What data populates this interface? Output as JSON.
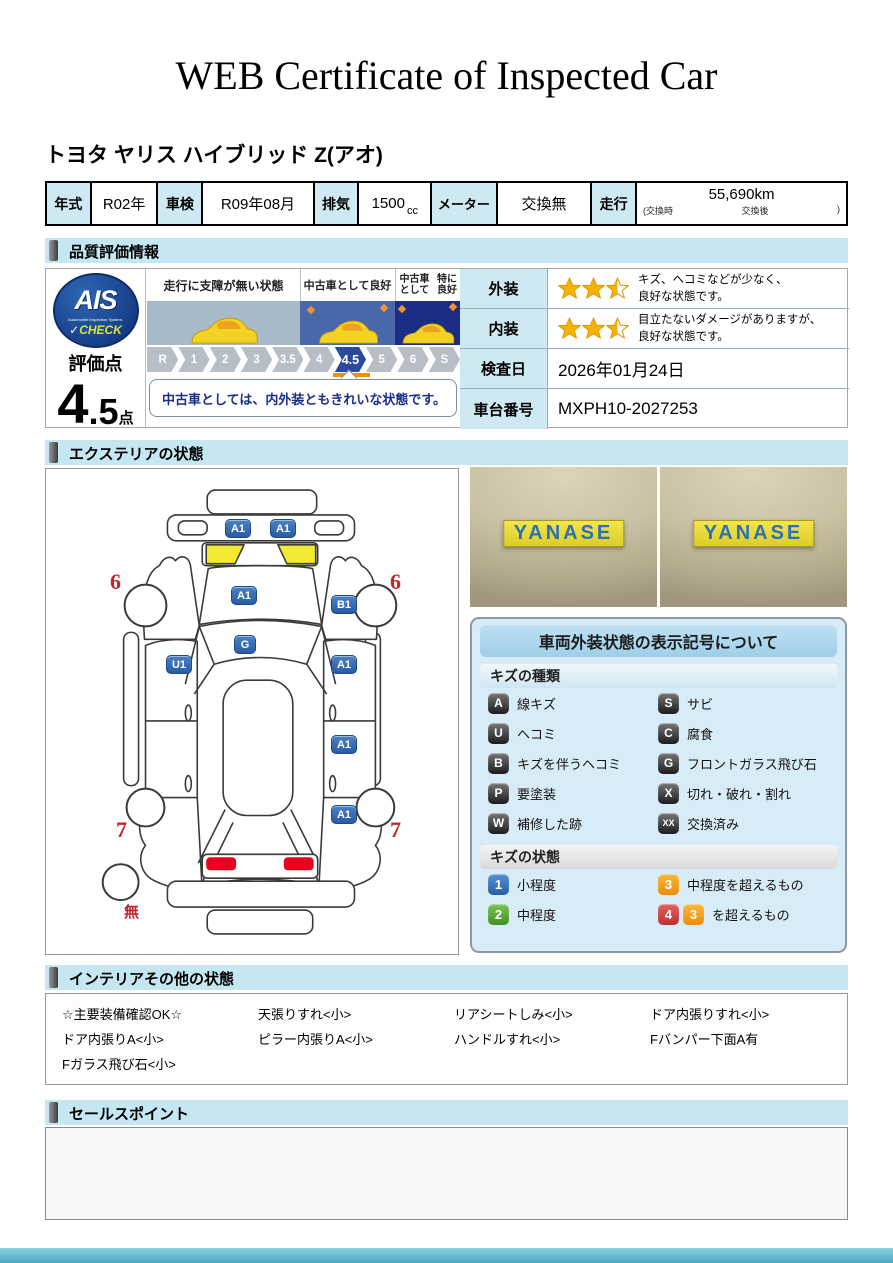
{
  "page": {
    "title": "WEB Certificate of Inspected Car",
    "vehicle_name": "トヨタ ヤリス ハイブリッド Z(アオ)"
  },
  "spec": {
    "year_label": "年式",
    "year_value": "R02年",
    "inspection_label": "車検",
    "inspection_value": "R09年08月",
    "displacement_label": "排気",
    "displacement_value": "1500",
    "displacement_unit": "cc",
    "meter_label": "メーター",
    "meter_value": "交換無",
    "mileage_label": "走行",
    "mileage_value": "55,690km",
    "mileage_sub_left": "(交換時",
    "mileage_sub_mid": "交換後",
    "mileage_sub_right": ")"
  },
  "sections": {
    "quality": "品質評価情報",
    "exterior": "エクステリアの状態",
    "interior": "インテリアその他の状態",
    "sales": "セールスポイント"
  },
  "quality": {
    "ais": {
      "logo": "AIS",
      "logo_sub": "Automobile Inspection System.",
      "check_mark": "✓",
      "logo_check": "CHECK"
    },
    "score_label": "評価点",
    "score_int": "4",
    "score_dec": ".5",
    "score_unit": "点",
    "zone_labels": [
      "走行に支障が無い状態",
      "中古車として良好",
      "中古車として",
      "特に良好"
    ],
    "scale": [
      "R",
      "1",
      "2",
      "3",
      "3.5",
      "4",
      "4.5",
      "5",
      "6",
      "S"
    ],
    "active_grade": "4.5",
    "comment": "中古車としては、内外装ともきれいな状態です。",
    "exterior_label": "外装",
    "exterior_text1": "キズ、ヘコミなどが少なく、",
    "exterior_text2": "良好な状態です。",
    "interior_label": "内装",
    "interior_text1": "目立たないダメージがありますが、",
    "interior_text2": "良好な状態です。",
    "date_label": "検査日",
    "date_value": "2026年01月24日",
    "vin_label": "車台番号",
    "vin_value": "MXPH10-2027253"
  },
  "diagram": {
    "markers": {
      "bumper_l": "A1",
      "bumper_r": "A1",
      "hood": "A1",
      "fender_r": "B1",
      "windshield": "G",
      "door_fl": "U1",
      "door_fr": "A1",
      "door_rr": "A1",
      "quarter_r": "A1",
      "wheel_fl": "6",
      "wheel_fr": "6",
      "wheel_rl": "7",
      "wheel_rr": "7",
      "spare": "無"
    }
  },
  "photos": {
    "sign1": "YANASE",
    "sign2": "YANASE"
  },
  "legend": {
    "title": "車両外装状態の表示記号について",
    "kinds_header": "キズの種類",
    "kinds": [
      {
        "code": "A",
        "label": "線キズ"
      },
      {
        "code": "S",
        "label": "サビ"
      },
      {
        "code": "U",
        "label": "ヘコミ"
      },
      {
        "code": "C",
        "label": "腐食"
      },
      {
        "code": "B",
        "label": "キズを伴うヘコミ"
      },
      {
        "code": "G",
        "label": "フロントガラス飛び石"
      },
      {
        "code": "P",
        "label": "要塗装"
      },
      {
        "code": "X",
        "label": "切れ・破れ・割れ"
      },
      {
        "code": "W",
        "label": "補修した跡"
      },
      {
        "code": "XX",
        "label": "交換済み"
      }
    ],
    "states_header": "キズの状態",
    "states": [
      {
        "code": "1",
        "label": "小程度"
      },
      {
        "code": "3",
        "label": "中程度を超えるもの"
      },
      {
        "code": "2",
        "label": "中程度"
      },
      {
        "code": "4",
        "code2": "3",
        "label": "を超えるもの"
      }
    ]
  },
  "interior": {
    "col1": [
      "☆主要装備確認OK☆",
      "ドア内張りA<小>",
      "Fガラス飛び石<小>"
    ],
    "col2": [
      "天張りすれ<小>",
      "ピラー内張りA<小>"
    ],
    "col3": [
      "リアシートしみ<小>",
      "ハンドルすれ<小>"
    ],
    "col4": [
      "ドア内張りすれ<小>",
      "Fバンパー下面A有"
    ]
  },
  "colors": {
    "section_bg": "#c5e7f1",
    "header_cell_bg": "#cfe9f3",
    "badge_blue": "#2e6db4",
    "star_gold": "#f5b301",
    "active_grade_bg": "#2b4a9b"
  }
}
